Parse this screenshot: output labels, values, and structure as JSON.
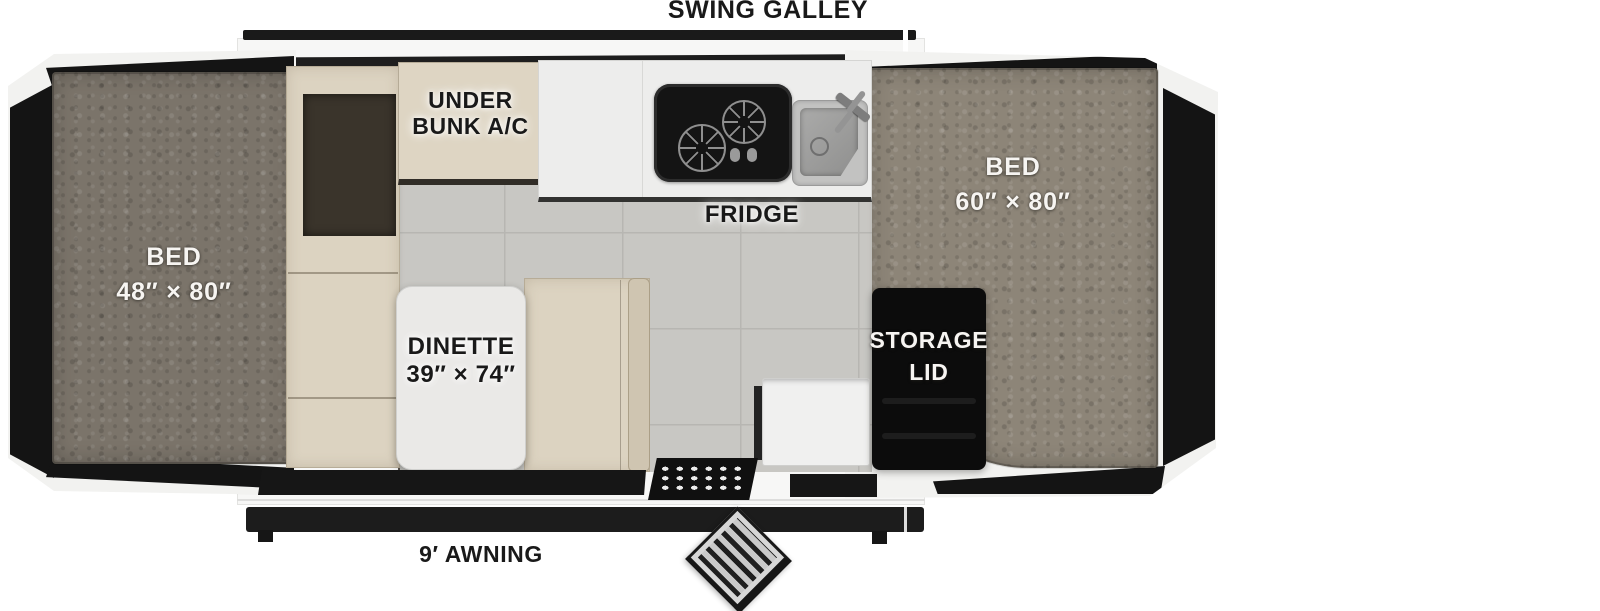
{
  "labels": {
    "swing_galley": "SWING GALLEY",
    "fridge": "FRIDGE",
    "awning": "9′ AWNING"
  },
  "areas": {
    "bed_left": {
      "name": "BED",
      "size": "48″ × 80″"
    },
    "bed_right": {
      "name": "BED",
      "size": "60″ × 80″"
    },
    "dinette": {
      "name": "DINETTE",
      "size": "39″ × 74″"
    },
    "under_bunk_ac": {
      "line1": "UNDER",
      "line2": "BUNK A/C"
    },
    "storage_lid": {
      "line1": "STORAGE",
      "line2": "LID"
    }
  },
  "colors": {
    "label_black": "#191919",
    "label_white": "#f7f5f2",
    "mattress_left": "#7b746a",
    "mattress_right": "#8d8578",
    "cushion_beige": "#dcd3c1",
    "tile_floor": "#c8c7c3",
    "tent_panel": "#141414",
    "frame_white": "#f2f2f0"
  }
}
